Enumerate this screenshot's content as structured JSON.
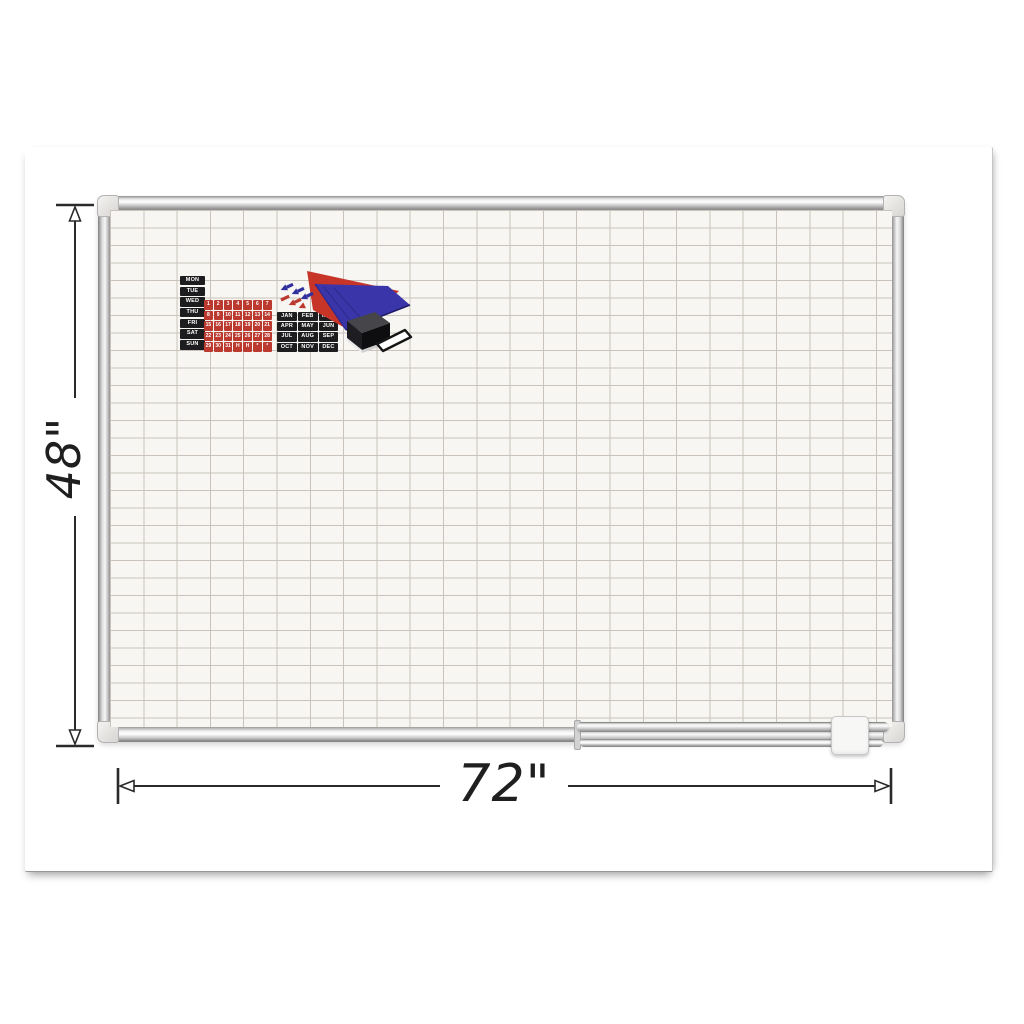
{
  "dimensions": {
    "height_label": "48\"",
    "width_label": "72\""
  },
  "calendar_kit": {
    "days": [
      "MON",
      "TUE",
      "WED",
      "THU",
      "FRI",
      "SAT",
      "SUN"
    ],
    "dates": [
      "1",
      "2",
      "3",
      "4",
      "5",
      "6",
      "7",
      "8",
      "9",
      "10",
      "11",
      "12",
      "13",
      "14",
      "15",
      "16",
      "17",
      "18",
      "19",
      "20",
      "21",
      "22",
      "23",
      "24",
      "25",
      "26",
      "27",
      "28",
      "29",
      "30",
      "31",
      "H",
      "H",
      "*",
      "*"
    ],
    "months": [
      "JAN",
      "FEB",
      "MAR",
      "APR",
      "MAY",
      "JUN",
      "JUL",
      "AUG",
      "SEP",
      "OCT",
      "NOV",
      "DEC"
    ]
  },
  "accessories": [
    "day-label-tiles",
    "date-tiles",
    "month-tiles",
    "red-magnet-sheet",
    "blue-magnet-sheet",
    "arrow-magnets",
    "eraser",
    "magnet-strip",
    "marker-tray"
  ],
  "colors": {
    "date_tile_red": "#bb392e",
    "label_tile_black": "#1d1d1f",
    "tile_text": "#ffffff",
    "sheet_red": "#c63528",
    "sheet_blue": "#3a35a8",
    "grid_line": "#c9c3bb",
    "board_surface": "#f8f6f2",
    "frame_silver": "#d9d9d9",
    "dimension_ink": "#2a2a2a"
  }
}
